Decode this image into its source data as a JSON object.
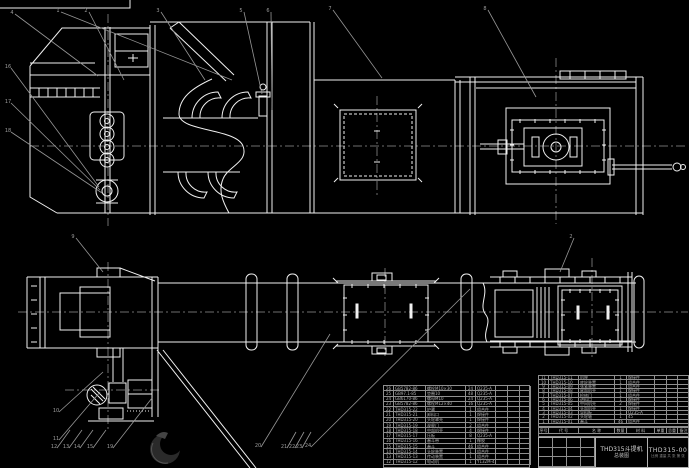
{
  "colors": {
    "background": "#000000",
    "line": "#f0f0f0",
    "leader": "#969696",
    "centerline": "#6e6e6e",
    "table_line": "#8f8f8f",
    "table_text": "#b2b2b2",
    "title_text": "#d6d6d6",
    "logo_dark": "#333333"
  },
  "title_block": {
    "product": "THD315斗提机",
    "drawing_type": "总装图",
    "drawing_no": "THD315-00",
    "extra": "比例  重量  共 张 第 张"
  },
  "bom_right": {
    "col_widths": [
      10,
      30,
      36,
      12,
      28,
      12,
      11,
      12
    ],
    "header": [
      "序号",
      "代 号",
      "名 称",
      "数量",
      "材 料",
      "单重",
      "总重",
      "备注"
    ],
    "rows": [
      [
        "11",
        "THD315-11",
        "机座",
        "1",
        "焊接件",
        "",
        "",
        ""
      ],
      [
        "10",
        "THD315-10",
        "底轮装置",
        "1",
        "组合件",
        "",
        "",
        ""
      ],
      [
        "9",
        "THD315-09",
        "张紧装置",
        "1",
        "组合件",
        "",
        "",
        ""
      ],
      [
        "8",
        "THD315-08",
        "尾部机壳",
        "1",
        "焊接件",
        "",
        "",
        ""
      ],
      [
        "7",
        "THD315-07",
        "检修门",
        "1",
        "组合件",
        "",
        "",
        ""
      ],
      [
        "6",
        "THD315-06",
        "进料口",
        "1",
        "焊接件",
        "",
        "",
        ""
      ],
      [
        "5",
        "THD315-05",
        "中间机壳",
        "2",
        "焊接件",
        "",
        "",
        ""
      ],
      [
        "4",
        "THD315-04",
        "头部机壳",
        "1",
        "焊接件",
        "",
        "",
        ""
      ],
      [
        "3",
        "THD315-03",
        "导料板",
        "1",
        "Q235-A",
        "",
        "",
        ""
      ],
      [
        "2",
        "THD315-02",
        "头轮轴",
        "1",
        "45",
        "",
        "",
        ""
      ],
      [
        "1",
        "THD315-01",
        "畚斗",
        "46",
        "组合件",
        "",
        "",
        ""
      ]
    ]
  },
  "bom_left": {
    "col_widths": [
      10,
      32,
      40,
      10,
      20,
      12,
      12,
      11
    ],
    "rows": [
      [
        "26",
        "GB5782-86",
        "螺栓M10×30",
        "24",
        "Q235-A",
        "",
        "",
        ""
      ],
      [
        "25",
        "GB97.1-85",
        "垫圈10",
        "48",
        "Q235-A",
        "",
        "",
        ""
      ],
      [
        "24",
        "GB6170-86",
        "螺母M10",
        "24",
        "Q235-A",
        "",
        "",
        ""
      ],
      [
        "23",
        "GB5782-86",
        "螺栓M12×40",
        "16",
        "Q235-A",
        "",
        "",
        ""
      ],
      [
        "22",
        "THD315-22",
        "护罩",
        "1",
        "组合件",
        "",
        "",
        ""
      ],
      [
        "21",
        "THD315-21",
        "卸料口",
        "1",
        "焊接件",
        "",
        "",
        ""
      ],
      [
        "20",
        "THD315-20",
        "头轮罩壳",
        "1",
        "焊接件",
        "",
        "",
        ""
      ],
      [
        "19",
        "THD315-19",
        "观察门",
        "2",
        "组合件",
        "",
        "",
        ""
      ],
      [
        "18",
        "THD315-18",
        "中部机壳",
        "4",
        "焊接件",
        "",
        "",
        ""
      ],
      [
        "17",
        "THD315-17",
        "压板",
        "8",
        "Q235-A",
        "",
        "",
        ""
      ],
      [
        "16",
        "THD315-16",
        "畚斗带",
        "1",
        "橡胶",
        "",
        "",
        ""
      ],
      [
        "15",
        "THD315-15",
        "畚斗",
        "46",
        "组合件",
        "",
        "",
        ""
      ],
      [
        "14",
        "THD315-14",
        "头轮装置",
        "1",
        "组合件",
        "",
        "",
        ""
      ],
      [
        "13",
        "THD315-13",
        "传动装置",
        "1",
        "组合件",
        "",
        "",
        ""
      ],
      [
        "12",
        "THD315-12",
        "电动机",
        "1",
        "Y132M-4",
        "",
        "",
        ""
      ]
    ]
  },
  "balloons": [
    {
      "n": "4",
      "lx": 12,
      "ly": 12,
      "x2": 98,
      "y2": 76
    },
    {
      "n": "1",
      "lx": 58,
      "ly": 10,
      "x2": 232,
      "y2": 80
    },
    {
      "n": "2",
      "lx": 86,
      "ly": 10,
      "x2": 124,
      "y2": 80
    },
    {
      "n": "3",
      "lx": 158,
      "ly": 10,
      "x2": 205,
      "y2": 80
    },
    {
      "n": "5",
      "lx": 241,
      "ly": 10,
      "x2": 262,
      "y2": 94
    },
    {
      "n": "6",
      "lx": 268,
      "ly": 10,
      "x2": 272,
      "y2": 110
    },
    {
      "n": "7",
      "lx": 330,
      "ly": 8,
      "x2": 382,
      "y2": 78
    },
    {
      "n": "8",
      "lx": 485,
      "ly": 8,
      "x2": 536,
      "y2": 97
    },
    {
      "n": "16",
      "lx": 8,
      "ly": 66,
      "x2": 99,
      "y2": 187
    },
    {
      "n": "17",
      "lx": 8,
      "ly": 101,
      "x2": 100,
      "y2": 190
    },
    {
      "n": "18",
      "lx": 8,
      "ly": 130,
      "x2": 102,
      "y2": 193
    },
    {
      "n": "9",
      "lx": 73,
      "ly": 236,
      "x2": 103,
      "y2": 272
    },
    {
      "n": "10",
      "lx": 56,
      "ly": 410,
      "x2": 103,
      "y2": 372
    },
    {
      "n": "11",
      "lx": 56,
      "ly": 438,
      "x2": 100,
      "y2": 392
    },
    {
      "n": "12",
      "lx": 54,
      "ly": 446,
      "x2": 70,
      "y2": 430
    },
    {
      "n": "13",
      "lx": 66,
      "ly": 446,
      "x2": 82,
      "y2": 430
    },
    {
      "n": "14",
      "lx": 77,
      "ly": 446,
      "x2": 93,
      "y2": 430
    },
    {
      "n": "15",
      "lx": 90,
      "ly": 446,
      "x2": 106,
      "y2": 430
    },
    {
      "n": "19",
      "lx": 110,
      "ly": 446,
      "x2": 152,
      "y2": 398
    },
    {
      "n": "20",
      "lx": 258,
      "ly": 445,
      "x2": 330,
      "y2": 334
    },
    {
      "n": "21",
      "lx": 284,
      "ly": 446,
      "x2": 296,
      "y2": 432
    },
    {
      "n": "22",
      "lx": 292,
      "ly": 446,
      "x2": 304,
      "y2": 432
    },
    {
      "n": "23",
      "lx": 299,
      "ly": 446,
      "x2": 311,
      "y2": 432
    },
    {
      "n": "24",
      "lx": 308,
      "ly": 445,
      "x2": 470,
      "y2": 289
    },
    {
      "n": "2",
      "lx": 571,
      "ly": 236,
      "x2": 560,
      "y2": 272
    }
  ]
}
